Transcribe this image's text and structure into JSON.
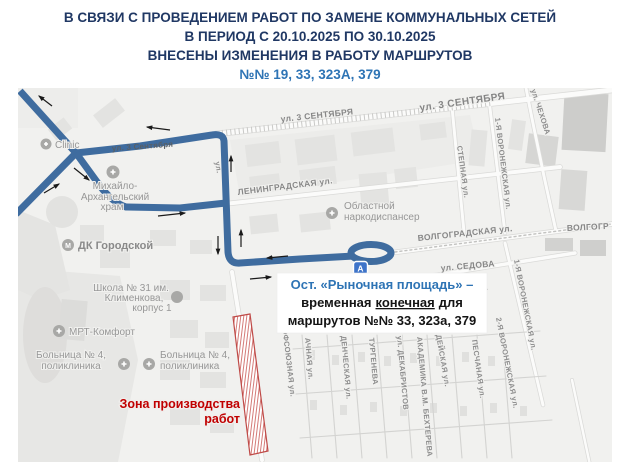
{
  "header": {
    "line1": "В СВЯЗИ С ПРОВЕДЕНИЕМ РАБОТ ПО ЗАМЕНЕ КОММУНАЛЬНЫХ СЕТЕЙ",
    "line2": "В ПЕРИОД С 20.10.2025 ПО 30.10.2025",
    "line3": "ВНЕСЕНЫ ИЗМЕНЕНИЯ В РАБОТУ МАРШРУТОВ",
    "line4": "№№ 19, 33, 323А, 379"
  },
  "colors": {
    "title_navy": "#203864",
    "accent_blue": "#2e74b5",
    "route_blue": "#3f6c9f",
    "work_red": "#c00000",
    "zone_red": "#bf4a47"
  },
  "map": {
    "streets": {
      "sentyabrya_on_route": "ул. 3 Сентября",
      "sentyabrya_mid": "ул. 3 СЕНТЯБРЯ",
      "sentyabrya_right": "ул. 3 СЕНТЯБРЯ",
      "leningradskaya": "ЛЕНИНГРАДСКАЯ ул.",
      "volgogradskaya": "ВОЛГОГРАДСКАЯ ул.",
      "volgogradskaya_fragment": "ВОЛГОГР",
      "sedova": "ул. СЕДОВА",
      "stepnaya": "СТЕПНАЯ ул.",
      "chehova": "ул. ЧЕХОВА",
      "voronezhskaya_1_top": "1-Я ВОРОНЕЖСКАЯ ул.",
      "voronezhskaya_1_bottom": "1-Я ВОРОНЕЖСКАЯ ул.",
      "voronezhskaya_2": "2-Я ВОРОНЕЖСКАЯ ул.",
      "peschanaya": "ПЕСЧАНАЯ ул.",
      "deyskaya": "ДЕЙСКАЯ ул.",
      "behtereva": "АКАДЕМИКА В.М. БЕХТЕРЕВА",
      "dekabristov": "ул. ДЕКАБРИСТОВ",
      "turgeneva": "ТУРГЕНЕВА",
      "dencheskaya": "ДЕНЧЕСКАЯ ул.",
      "achnaya": "АЧНАЯ ул.",
      "profsoyuznaya": "ПРОФСОЮЗНАЯ ул.",
      "na_fragment": "НА",
      "hidden_street_fragment": "ул."
    },
    "poi": {
      "clinic": "Clinic",
      "temple_line1": "Михайло-",
      "temple_line2": "Архангельский",
      "temple_line3": "храм",
      "dk": "ДК Городской",
      "narco_line1": "Областной",
      "narco_line2": "наркодиспансер",
      "school_line1": "Школа № 31 им.",
      "school_line2": "Клименкова,",
      "school_line3": "корпус 1",
      "mrt": "МРТ-Комфорт",
      "hospital_line1": "Больница № 4,",
      "hospital_line2": "поликлиника"
    },
    "bus_stop_letter": "А",
    "callout": {
      "line1": "Ост. «Рыночная площадь» –",
      "line2_part1": "временная",
      "line2_underlined": "конечная",
      "line2_part2": "для",
      "line3": "маршрутов №№ 33, 323а, 379"
    },
    "work_zone": {
      "label_line1": "Зона производства",
      "label_line2": "работ"
    }
  }
}
